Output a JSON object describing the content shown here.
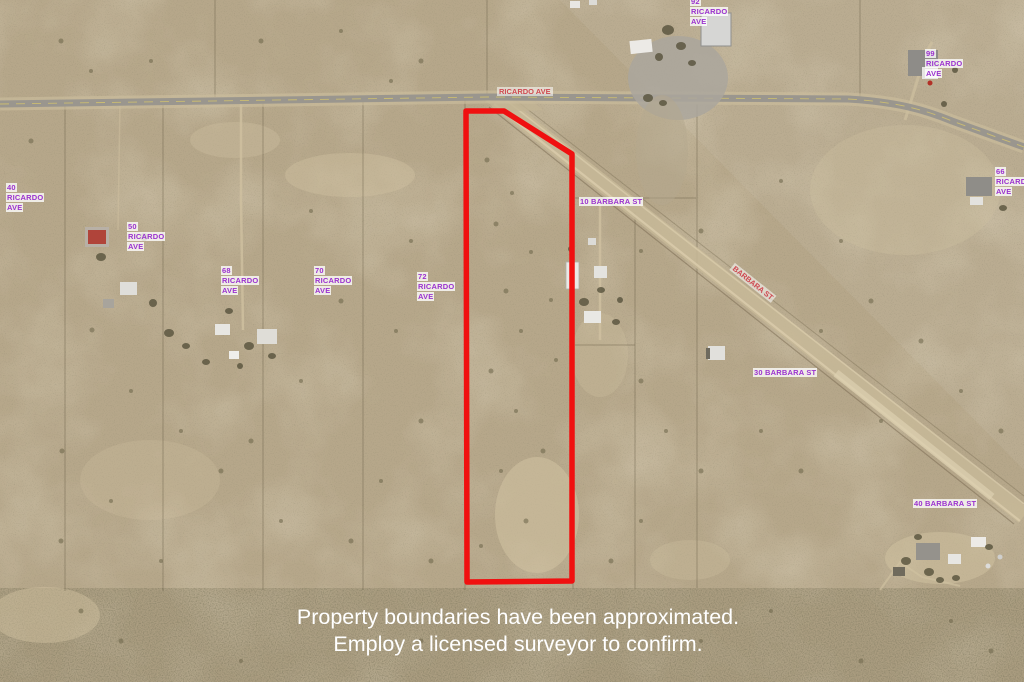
{
  "map": {
    "kind": "aerial-satellite-photo",
    "boundary_note": "red outline of subject parcel"
  },
  "colors": {
    "boundary_red": "#f01010",
    "address_label_text": "#9b32cf",
    "address_label_bg": "rgba(255,255,255,0.78)",
    "road_label_text": "#cf4a52",
    "road_label_bg": "rgba(255,255,255,0.55)",
    "disclaimer_text": "#ffffff",
    "terrain_base": "#b6a78a"
  },
  "road_labels": [
    {
      "text": "RICARDO AVE"
    },
    {
      "text": "BARBARA ST"
    }
  ],
  "address_labels": [
    {
      "text": "92 RICARDO AVE"
    },
    {
      "text": "99 RICARDO AVE"
    },
    {
      "text": "66 RICARDO AVE"
    },
    {
      "text": "40 RICARDO AVE"
    },
    {
      "text": "50 RICARDO AVE"
    },
    {
      "text": "68 RICARDO AVE"
    },
    {
      "text": "70 RICARDO AVE"
    },
    {
      "text": "72 RICARDO AVE"
    },
    {
      "text": "10 BARBARA ST"
    },
    {
      "text": "30 BARBARA ST"
    },
    {
      "text": "40 BARBARA ST"
    }
  ],
  "disclaimer": {
    "line1": "Property boundaries have been approximated.",
    "line2": "Employ a licensed surveyor to confirm."
  }
}
